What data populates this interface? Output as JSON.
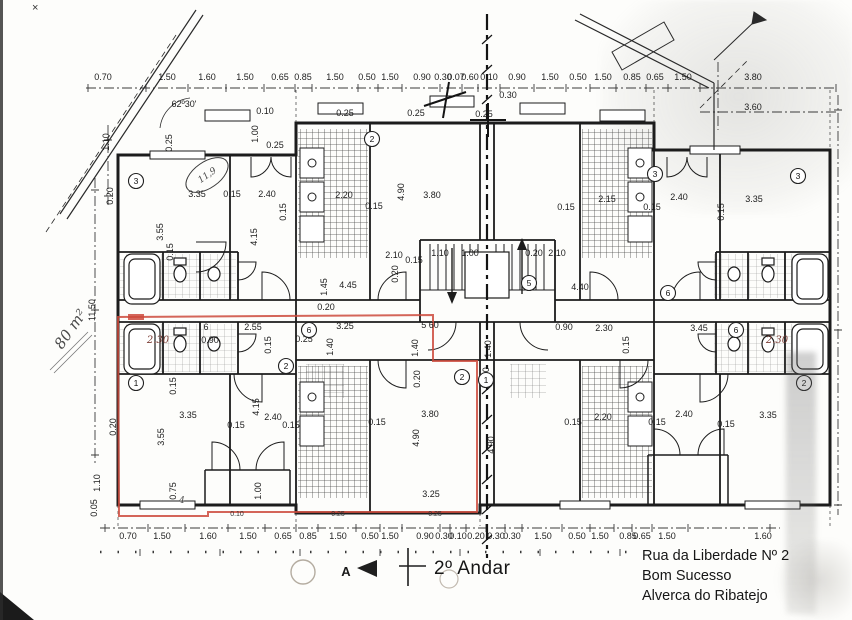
{
  "colors": {
    "outline_red": "#cc4a3c",
    "ink": "#1c1c1c"
  },
  "plan": {
    "dims_top": [
      "0.70",
      "1.50",
      "1.60",
      "1.50",
      "0.65",
      "0.85",
      "1.50",
      "0.50",
      "1.50",
      "0.90",
      "0.30",
      "0.07",
      "0.60",
      "0.10",
      "0.90",
      "1.50",
      "0.50",
      "1.50",
      "0.85",
      "0.65",
      "1.50",
      "3.80"
    ],
    "dims_bottom": [
      "0.70",
      "1.50",
      "1.60",
      "1.50",
      "0.65",
      "0.85",
      "1.50",
      "0.50",
      "1.50",
      "0.90",
      "0.30",
      "0.10",
      "0.20",
      "0.30",
      "0.30",
      "1.50",
      "0.50",
      "1.50",
      "0.85",
      "0.65",
      "1.50",
      "1.60"
    ],
    "annot": [
      "3.60",
      "0.30",
      "0.25",
      "0.10",
      "1.00",
      "0.25",
      "0.25",
      "62º30'",
      "0.25",
      "0.25",
      "3.35",
      "0.15",
      "2.40",
      "0.15",
      "3.55",
      "4.15",
      "2.20",
      "0.15",
      "4.90",
      "3.80",
      "2.10",
      "0.15",
      "1.10",
      "1.00",
      "0.20",
      "0.20",
      "2.10",
      "4.45",
      "1.45",
      "4.40",
      "5 60",
      "1.40",
      "1.40",
      "0.20",
      "6",
      "2.55",
      "3.25",
      "0.90",
      "2.30",
      "0.15",
      "0.25",
      "1.40",
      "0.20",
      "0.90",
      "2.30",
      "3.45",
      "0.15",
      "2.30",
      "2.15",
      "0.15",
      "2.40",
      "0.15",
      "3.35",
      "0.15",
      "0.20",
      "3.80",
      "0.15",
      "4.90",
      "4.90",
      "3.25",
      "3.35",
      "3.55",
      "4.15",
      "2.40",
      "0.15",
      "0.15",
      "0.15",
      "1.00",
      "0.75",
      "2.40",
      "0.15",
      "3.35",
      "0.15",
      "0.15",
      "0.10",
      "0.25",
      "0.25",
      "0.20",
      "0.15",
      "2.20",
      "0.05",
      "1.10",
      "1.10",
      "0.20",
      "11.50",
      "11,9",
      "4"
    ],
    "circles": [
      "3",
      "2",
      "3",
      "3",
      "5",
      "6",
      "6",
      "6",
      "2",
      "1",
      "1",
      "2",
      "2"
    ],
    "area_note": "80 m²",
    "xmark": "×"
  },
  "footer": {
    "floor": "2º Andar",
    "section": "A",
    "addr1": "Rua da Liberdade Nº 2",
    "addr2": "Bom Sucesso",
    "addr3": "Alverca do Ribatejo"
  }
}
